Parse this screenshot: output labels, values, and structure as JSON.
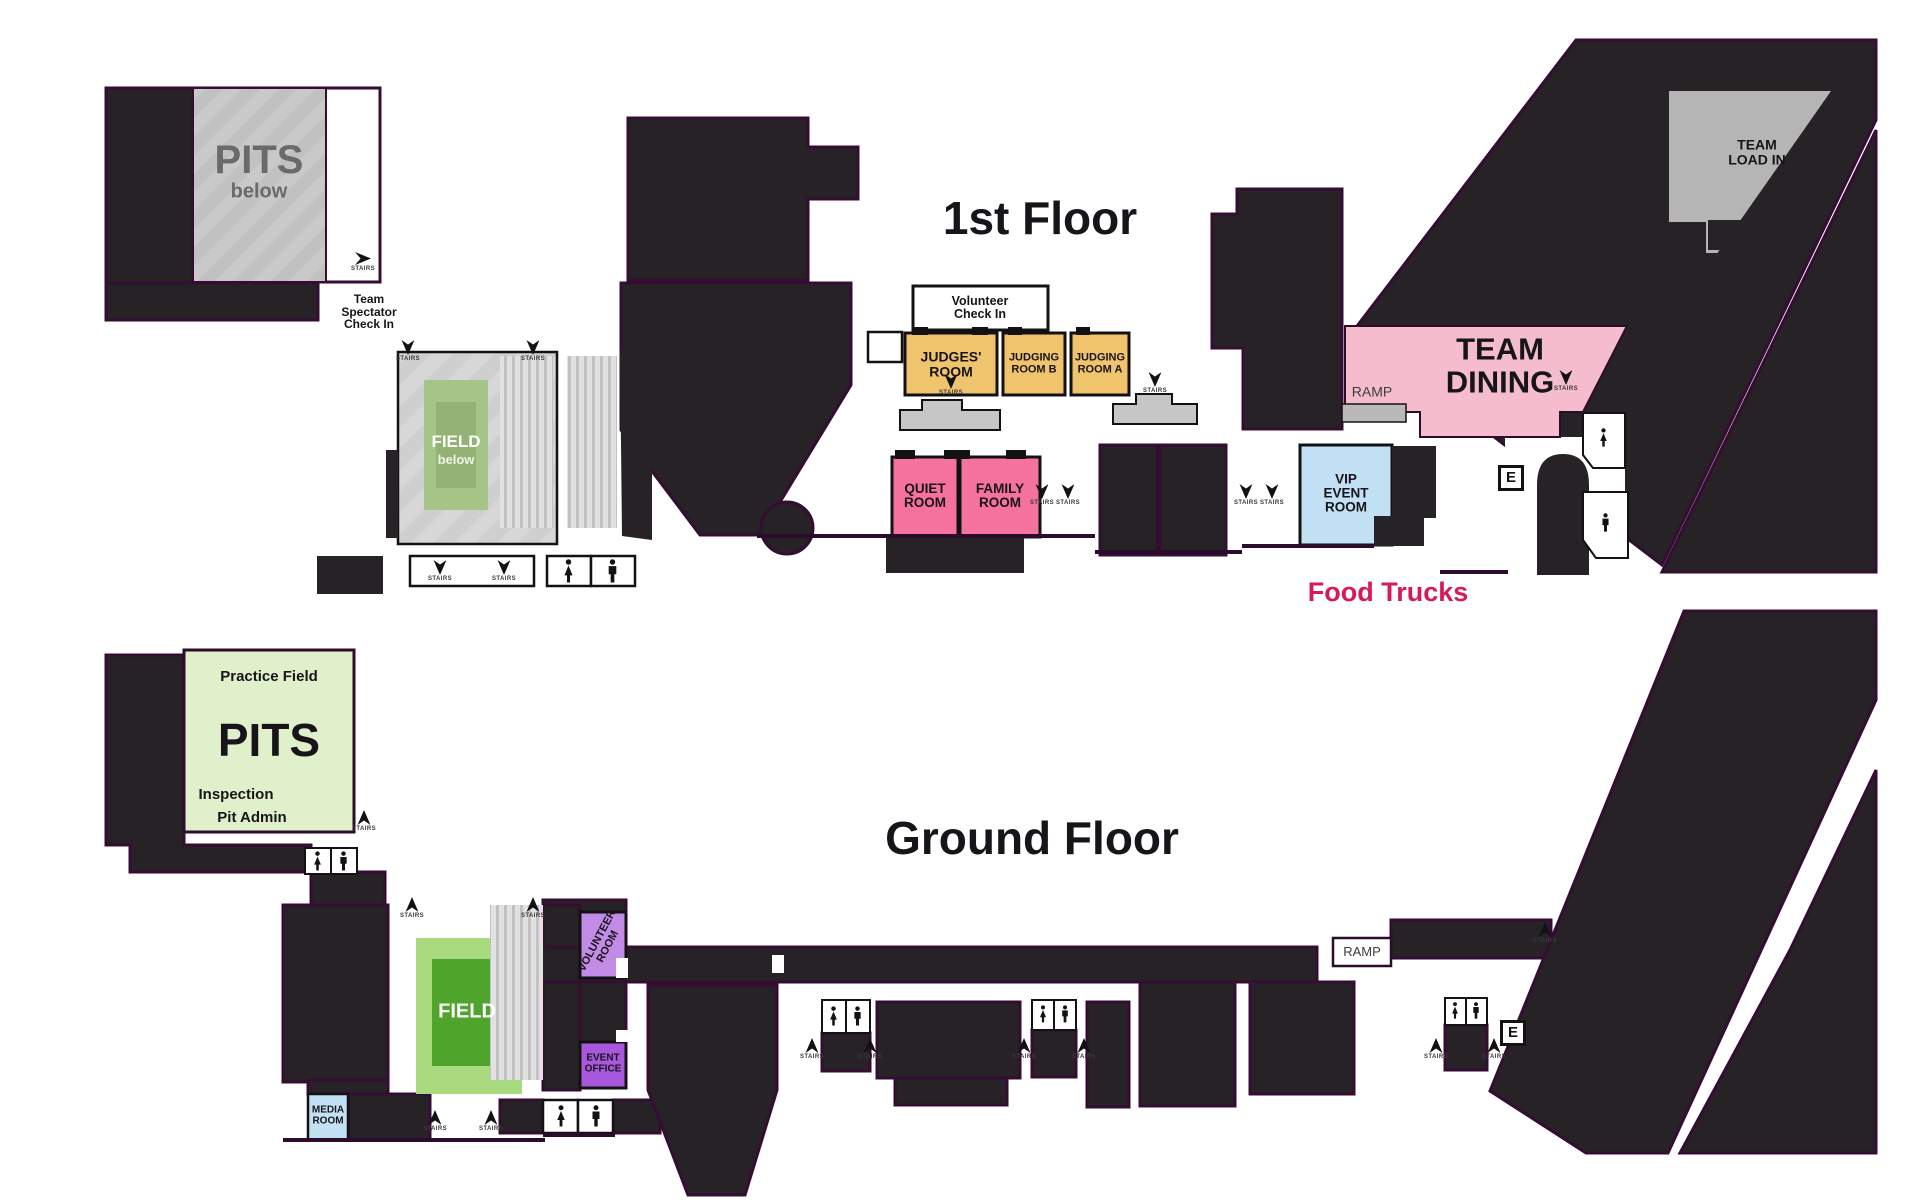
{
  "first_floor": {
    "title": "1st Floor",
    "rooms": {
      "pits_below": {
        "title": "PITS",
        "subtitle": "below"
      },
      "field_below": {
        "title": "FIELD",
        "subtitle": "below"
      },
      "team_spectator_check_in": "Team\nSpectator\nCheck In",
      "volunteer_check_in": "Volunteer\nCheck In",
      "judges_room": "JUDGES'\nROOM",
      "judging_room_b": "JUDGING\nROOM B",
      "judging_room_a": "JUDGING\nROOM A",
      "quiet_room": "QUIET\nROOM",
      "family_room": "FAMILY\nROOM",
      "vip_event_room": "VIP\nEVENT\nROOM",
      "team_dining": "TEAM\nDINING",
      "team_load_in": "TEAM\nLOAD IN",
      "ramp": "RAMP",
      "food_trucks": "Food Trucks"
    }
  },
  "ground_floor": {
    "title": "Ground Floor",
    "rooms": {
      "practice_field": "Practice Field",
      "pits": "PITS",
      "inspection": "Inspection",
      "pit_admin": "Pit Admin",
      "field": "FIELD",
      "volunteer_room": "VOLUNTEER\nROOM",
      "event_office": "EVENT\nOFFICE",
      "media_room": "MEDIA\nROOM",
      "ramp": "RAMP"
    }
  },
  "labels": {
    "stairs": "STAIRS",
    "elevator": "E"
  },
  "colors": {
    "building": "#262226",
    "outline": "#350d33",
    "pits_gray": "#c9c9c9",
    "seating_gray": "#d9d9d9",
    "judging_orange": "#efc46c",
    "team_dining_pink": "#f5bccd",
    "room_pink": "#f5729e",
    "vip_blue": "#c2e1f5",
    "media_blue": "#c2e1f5",
    "pits_green": "#e0f0ca",
    "field_green_outer": "#a9da7f",
    "field_green_inner": "#4fa42c",
    "field_below_green_outer": "#a5c488",
    "field_below_green_inner": "#93b274",
    "volunteer_purple": "#c28be6",
    "event_office_purple": "#a957dd",
    "load_in_gray": "#b5b5b5",
    "food_trucks_text": "#d6195c"
  }
}
